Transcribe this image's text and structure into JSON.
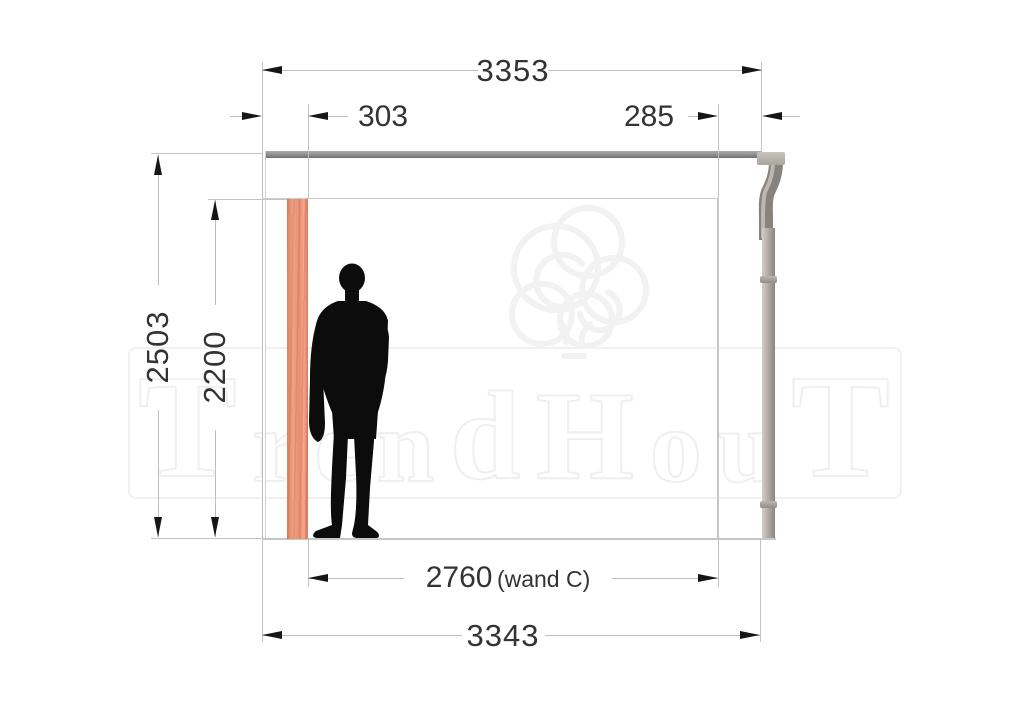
{
  "watermark": {
    "brand": "TrendHout",
    "letters": [
      "T",
      "r",
      "e",
      "n",
      "d",
      "H",
      "o",
      "u",
      "T"
    ]
  },
  "dimensions": {
    "top_total": "3353",
    "left_inset": "303",
    "right_inset": "285",
    "height_outer": "2503",
    "height_inner": "2200",
    "wall_c_value": "2760",
    "wall_c_suffix": "(wand C)",
    "bottom_total": "3343"
  },
  "structure": {
    "elements": [
      "roof-beam",
      "gutter-outlet",
      "downpipe",
      "wood-post",
      "person-silhouette"
    ]
  },
  "colors": {
    "wood_post": "#ec9478",
    "roof_beam": "#8e8e8e",
    "downpipe": "#b2a8a3",
    "dimension_text": "#333333",
    "dimension_line": "#bdbdbd",
    "silhouette": "#0c0c0c",
    "watermark_outline": "#efefef"
  }
}
